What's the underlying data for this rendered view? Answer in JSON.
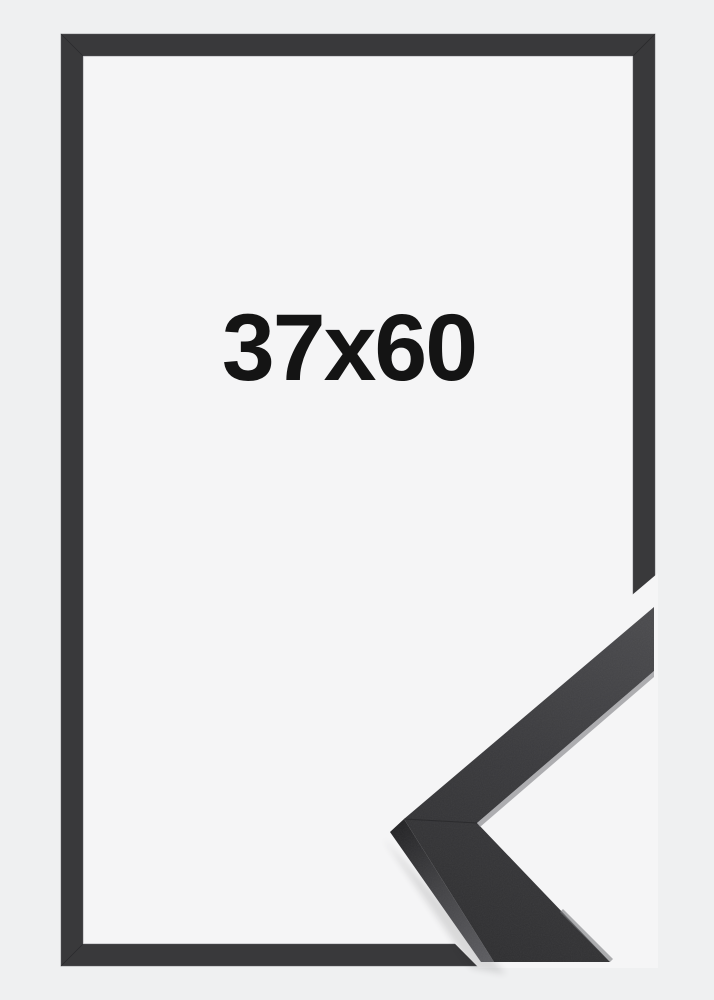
{
  "product": {
    "size_label": "37x60"
  },
  "colors": {
    "page_background": "#eff0f1",
    "frame_interior": "#f5f5f6",
    "frame_band": "#39393b",
    "band_edge_highlight": "#5e5e62",
    "corner_face_light": "#4b4b4e",
    "corner_face_mid": "#3a3a3d",
    "corner_face_dark": "#2f2f31",
    "corner_side_dark": "#232325",
    "corner_side_light": "#5c5c60",
    "label_text": "#141414"
  }
}
